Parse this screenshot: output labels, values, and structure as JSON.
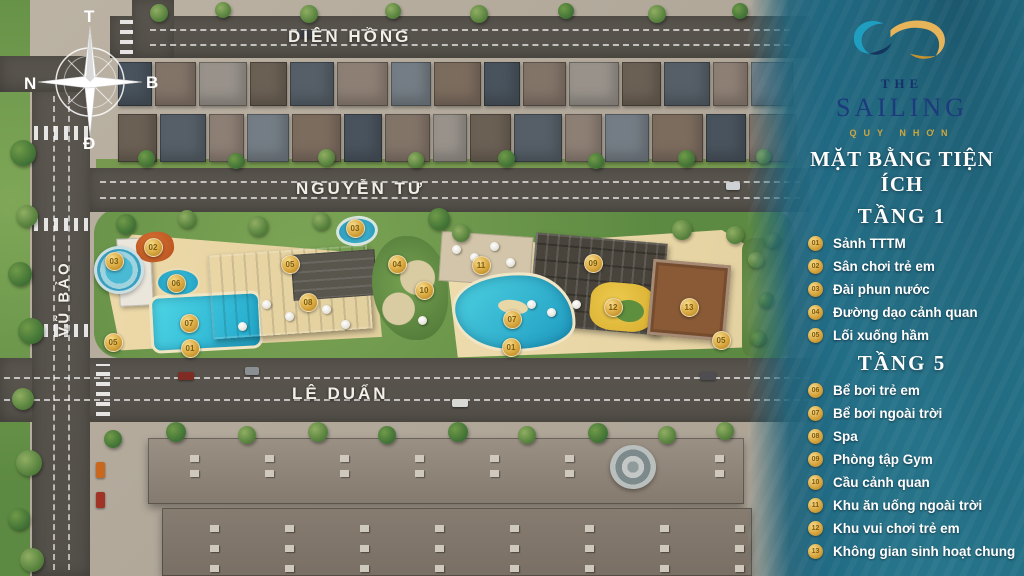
{
  "brand": {
    "the": "THE",
    "name": "SAILING",
    "location": "QUY NHƠN"
  },
  "panel": {
    "title": "MẶT BẰNG TIỆN ÍCH"
  },
  "legend": {
    "sections": [
      {
        "heading": "TẦNG 1",
        "items": [
          {
            "num": "01",
            "label": "Sảnh TTTM"
          },
          {
            "num": "02",
            "label": "Sân chơi trẻ em"
          },
          {
            "num": "03",
            "label": "Đài phun nước"
          },
          {
            "num": "04",
            "label": "Đường dạo cảnh quan"
          },
          {
            "num": "05",
            "label": "Lối xuống hầm"
          }
        ]
      },
      {
        "heading": "TẦNG 5",
        "items": [
          {
            "num": "06",
            "label": "Bể bơi trẻ em"
          },
          {
            "num": "07",
            "label": "Bể bơi ngoài trời"
          },
          {
            "num": "08",
            "label": "Spa"
          },
          {
            "num": "09",
            "label": "Phòng tập Gym"
          },
          {
            "num": "10",
            "label": "Cầu cảnh quan"
          },
          {
            "num": "11",
            "label": "Khu ăn uống ngoài trời"
          },
          {
            "num": "12",
            "label": "Khu vui chơi trẻ em"
          },
          {
            "num": "13",
            "label": "Không gian sinh hoạt chung"
          }
        ]
      }
    ]
  },
  "streets": [
    {
      "id": "dien-hong",
      "name": "DIÊN HỒNG"
    },
    {
      "id": "nguyen-tu",
      "name": "NGUYỄN TƯ"
    },
    {
      "id": "le-duan",
      "name": "LÊ DUẨN"
    },
    {
      "id": "vu-bao",
      "name": "VŨ BẢO"
    }
  ],
  "compass": {
    "top": "T",
    "right": "B",
    "bottom": "Đ",
    "left": "N"
  },
  "map_markers": [
    {
      "num": "02",
      "x": 152,
      "y": 246
    },
    {
      "num": "03",
      "x": 113,
      "y": 260
    },
    {
      "num": "06",
      "x": 175,
      "y": 282
    },
    {
      "num": "07",
      "x": 188,
      "y": 322
    },
    {
      "num": "05",
      "x": 112,
      "y": 341
    },
    {
      "num": "01",
      "x": 189,
      "y": 347
    },
    {
      "num": "05",
      "x": 289,
      "y": 263
    },
    {
      "num": "08",
      "x": 307,
      "y": 301
    },
    {
      "num": "03",
      "x": 354,
      "y": 227
    },
    {
      "num": "04",
      "x": 396,
      "y": 263
    },
    {
      "num": "10",
      "x": 423,
      "y": 289
    },
    {
      "num": "11",
      "x": 480,
      "y": 264
    },
    {
      "num": "09",
      "x": 592,
      "y": 262
    },
    {
      "num": "07",
      "x": 511,
      "y": 318
    },
    {
      "num": "12",
      "x": 612,
      "y": 306
    },
    {
      "num": "01",
      "x": 510,
      "y": 346
    },
    {
      "num": "13",
      "x": 688,
      "y": 306
    },
    {
      "num": "05",
      "x": 720,
      "y": 339
    }
  ],
  "colors": {
    "gold": "#d9a73e",
    "navy": "#1d3a7c",
    "sea": "#2b7e93",
    "pool": "#35c2d8"
  }
}
